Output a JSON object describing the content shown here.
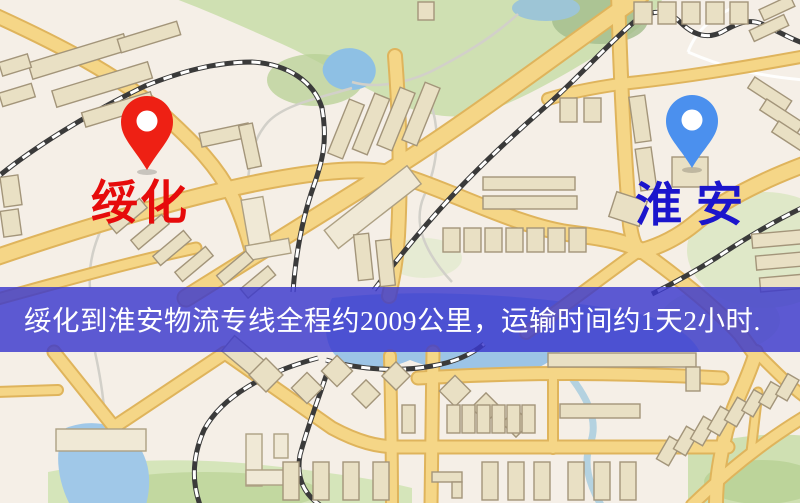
{
  "banner": {
    "text": "绥化到淮安物流专线全程约2009公里，运输时间约1天2小时.",
    "bg_color": "#3b38cd",
    "text_color": "#ffffff"
  },
  "markers": {
    "origin": {
      "label": "绥化",
      "label_color": "#e60b0b",
      "pin_color": "#ee2014"
    },
    "destination": {
      "label": "淮安",
      "label_color": "#1b15cc",
      "pin_color": "#4b90ee"
    }
  },
  "map_colors": {
    "background": "#f5efe7",
    "road_fill": "#f5d687",
    "road_edge": "#dfb45c",
    "park_green": "#cfe0b2",
    "water_blue": "#9cc4e6",
    "building_tan": "#e9e0c4",
    "railway_dark": "#3a3a3a"
  }
}
